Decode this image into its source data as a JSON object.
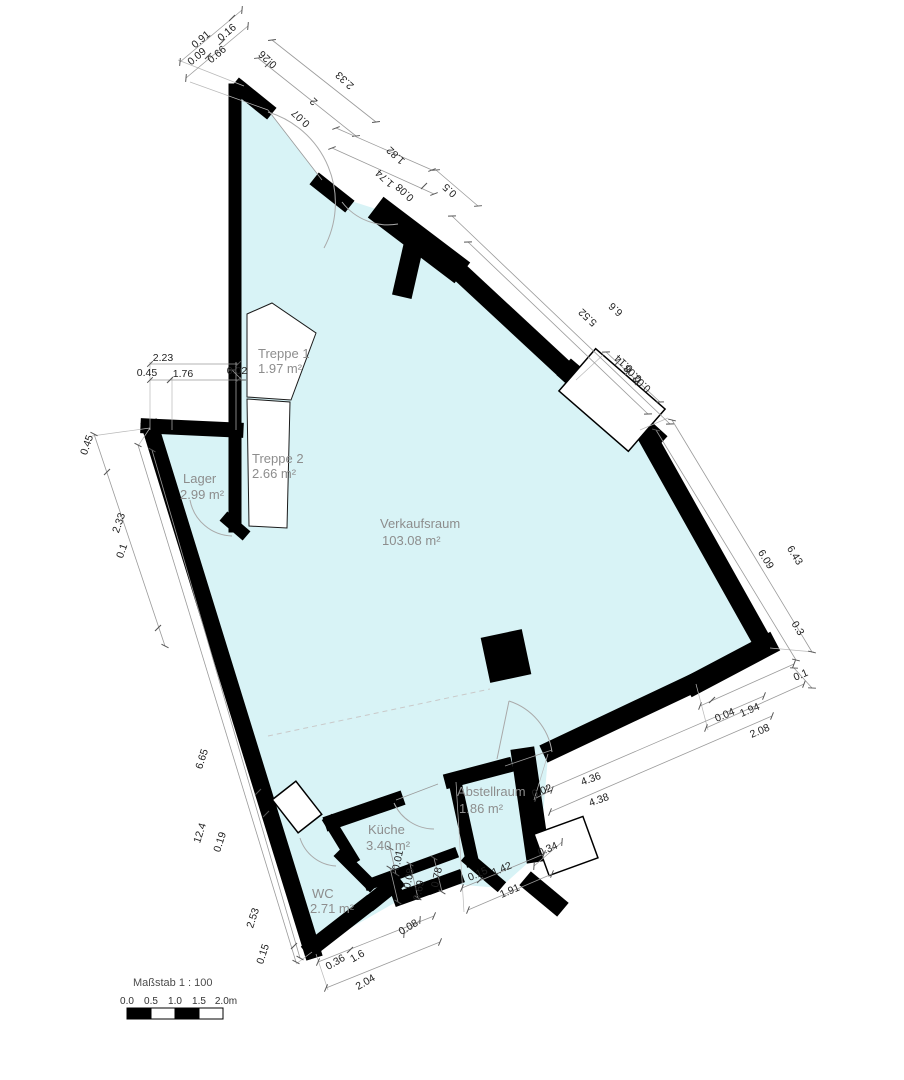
{
  "plan": {
    "rooms": [
      {
        "name": "Treppe 1",
        "area": "1.97 m²"
      },
      {
        "name": "Treppe 2",
        "area": "2.66 m²"
      },
      {
        "name": "Lager",
        "area": "2.99 m²"
      },
      {
        "name": "Verkaufsraum",
        "area": "103.08 m²"
      },
      {
        "name": "Küche",
        "area": "3.40 m²"
      },
      {
        "name": "WC",
        "area": "2.71 m²"
      },
      {
        "name": "Abstellraum",
        "area": "1.86 m²"
      }
    ],
    "dims": [
      "0.91",
      "0.16",
      "0.09",
      "0.66",
      "0.26",
      "2.33",
      "2",
      "0.07",
      "1.82",
      "1.74",
      "0.08",
      "0.5",
      "5.52",
      "6.6",
      "0.14",
      "0.08",
      "0.02",
      "6.09",
      "6.43",
      "0.3",
      "0.1",
      "0.04",
      "1.94",
      "2.08",
      "0.02",
      "4.36",
      "4.38",
      "0.34",
      "0.15",
      "1.42",
      "1.91",
      "0.08",
      "0.69",
      "0.78",
      "0.01",
      "0.08",
      "0.36",
      "1.6",
      "2.04",
      "0.15",
      "2.53",
      "0.19",
      "12.4",
      "6.65",
      "0.1",
      "2.33",
      "0.45",
      "2.23",
      "0.45",
      "1.76",
      "0.02"
    ],
    "scale": {
      "label": "Maßstab 1 : 100",
      "ticks": [
        "0.0",
        "0.5",
        "1.0",
        "1.5",
        "2.0m"
      ]
    },
    "colors": {
      "floor": "#d8f3f6",
      "wall": "#000000",
      "dim_line": "#9a9a9a",
      "room_label": "#8d8d8d"
    }
  }
}
